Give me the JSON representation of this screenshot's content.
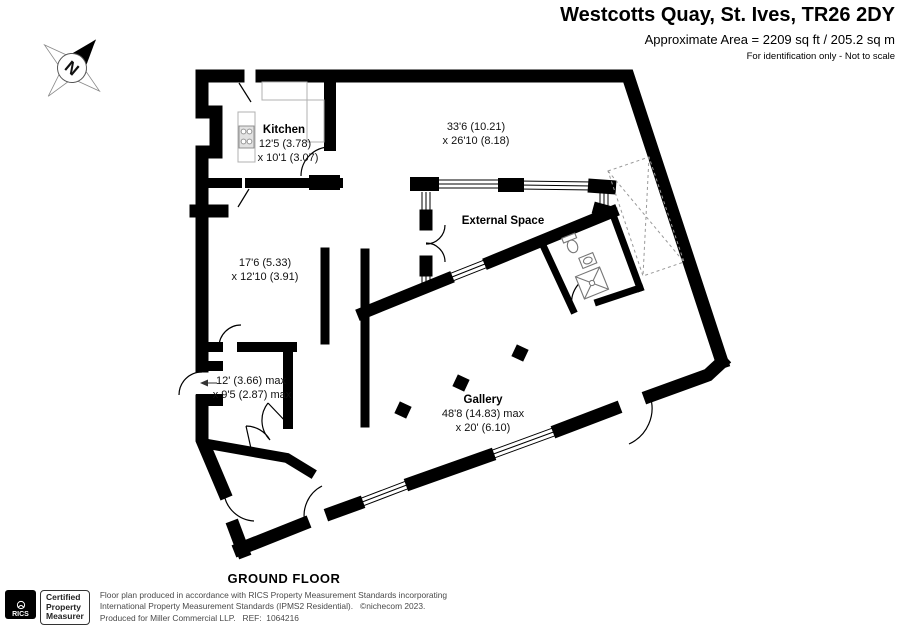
{
  "header": {
    "title": "Westcotts Quay, St. Ives, TR26 2DY",
    "area": "Approximate Area = 2209 sq ft / 205.2 sq m",
    "note": "For identification only - Not to scale"
  },
  "compass": {
    "north_label": "N"
  },
  "plan": {
    "floor_label": "GROUND FLOOR",
    "rooms": [
      {
        "name": "Kitchen",
        "dim1": "12'5 (3.78)",
        "dim2": "x 10'1 (3.07)"
      },
      {
        "name": "",
        "dim1": "33'6 (10.21)",
        "dim2": "x 26'10 (8.18)"
      },
      {
        "name": "External Space",
        "dim1": "",
        "dim2": ""
      },
      {
        "name": "",
        "dim1": "17'6 (5.33)",
        "dim2": "x 12'10 (3.91)"
      },
      {
        "name": "",
        "dim1": "12' (3.66) max",
        "dim2": "x 9'5 (2.87) max"
      },
      {
        "name": "Gallery",
        "dim1": "48'8 (14.83) max",
        "dim2": "x 20' (6.10)"
      }
    ]
  },
  "footer": {
    "rics_label": "RICS",
    "certification": [
      "Certified",
      "Property",
      "Measurer"
    ],
    "disclaimer": [
      "Floor plan produced in accordance with RICS Property Measurement Standards incorporating",
      "International Property Measurement Standards (IPMS2 Residential).   ©nichecom 2023.",
      "Produced for Miller Commercial LLP.   REF:  1064216"
    ]
  },
  "colors": {
    "wall": "#000000",
    "muted_text": "#4a4a4a",
    "fixture": "#777777",
    "void_dash": "#999999"
  }
}
